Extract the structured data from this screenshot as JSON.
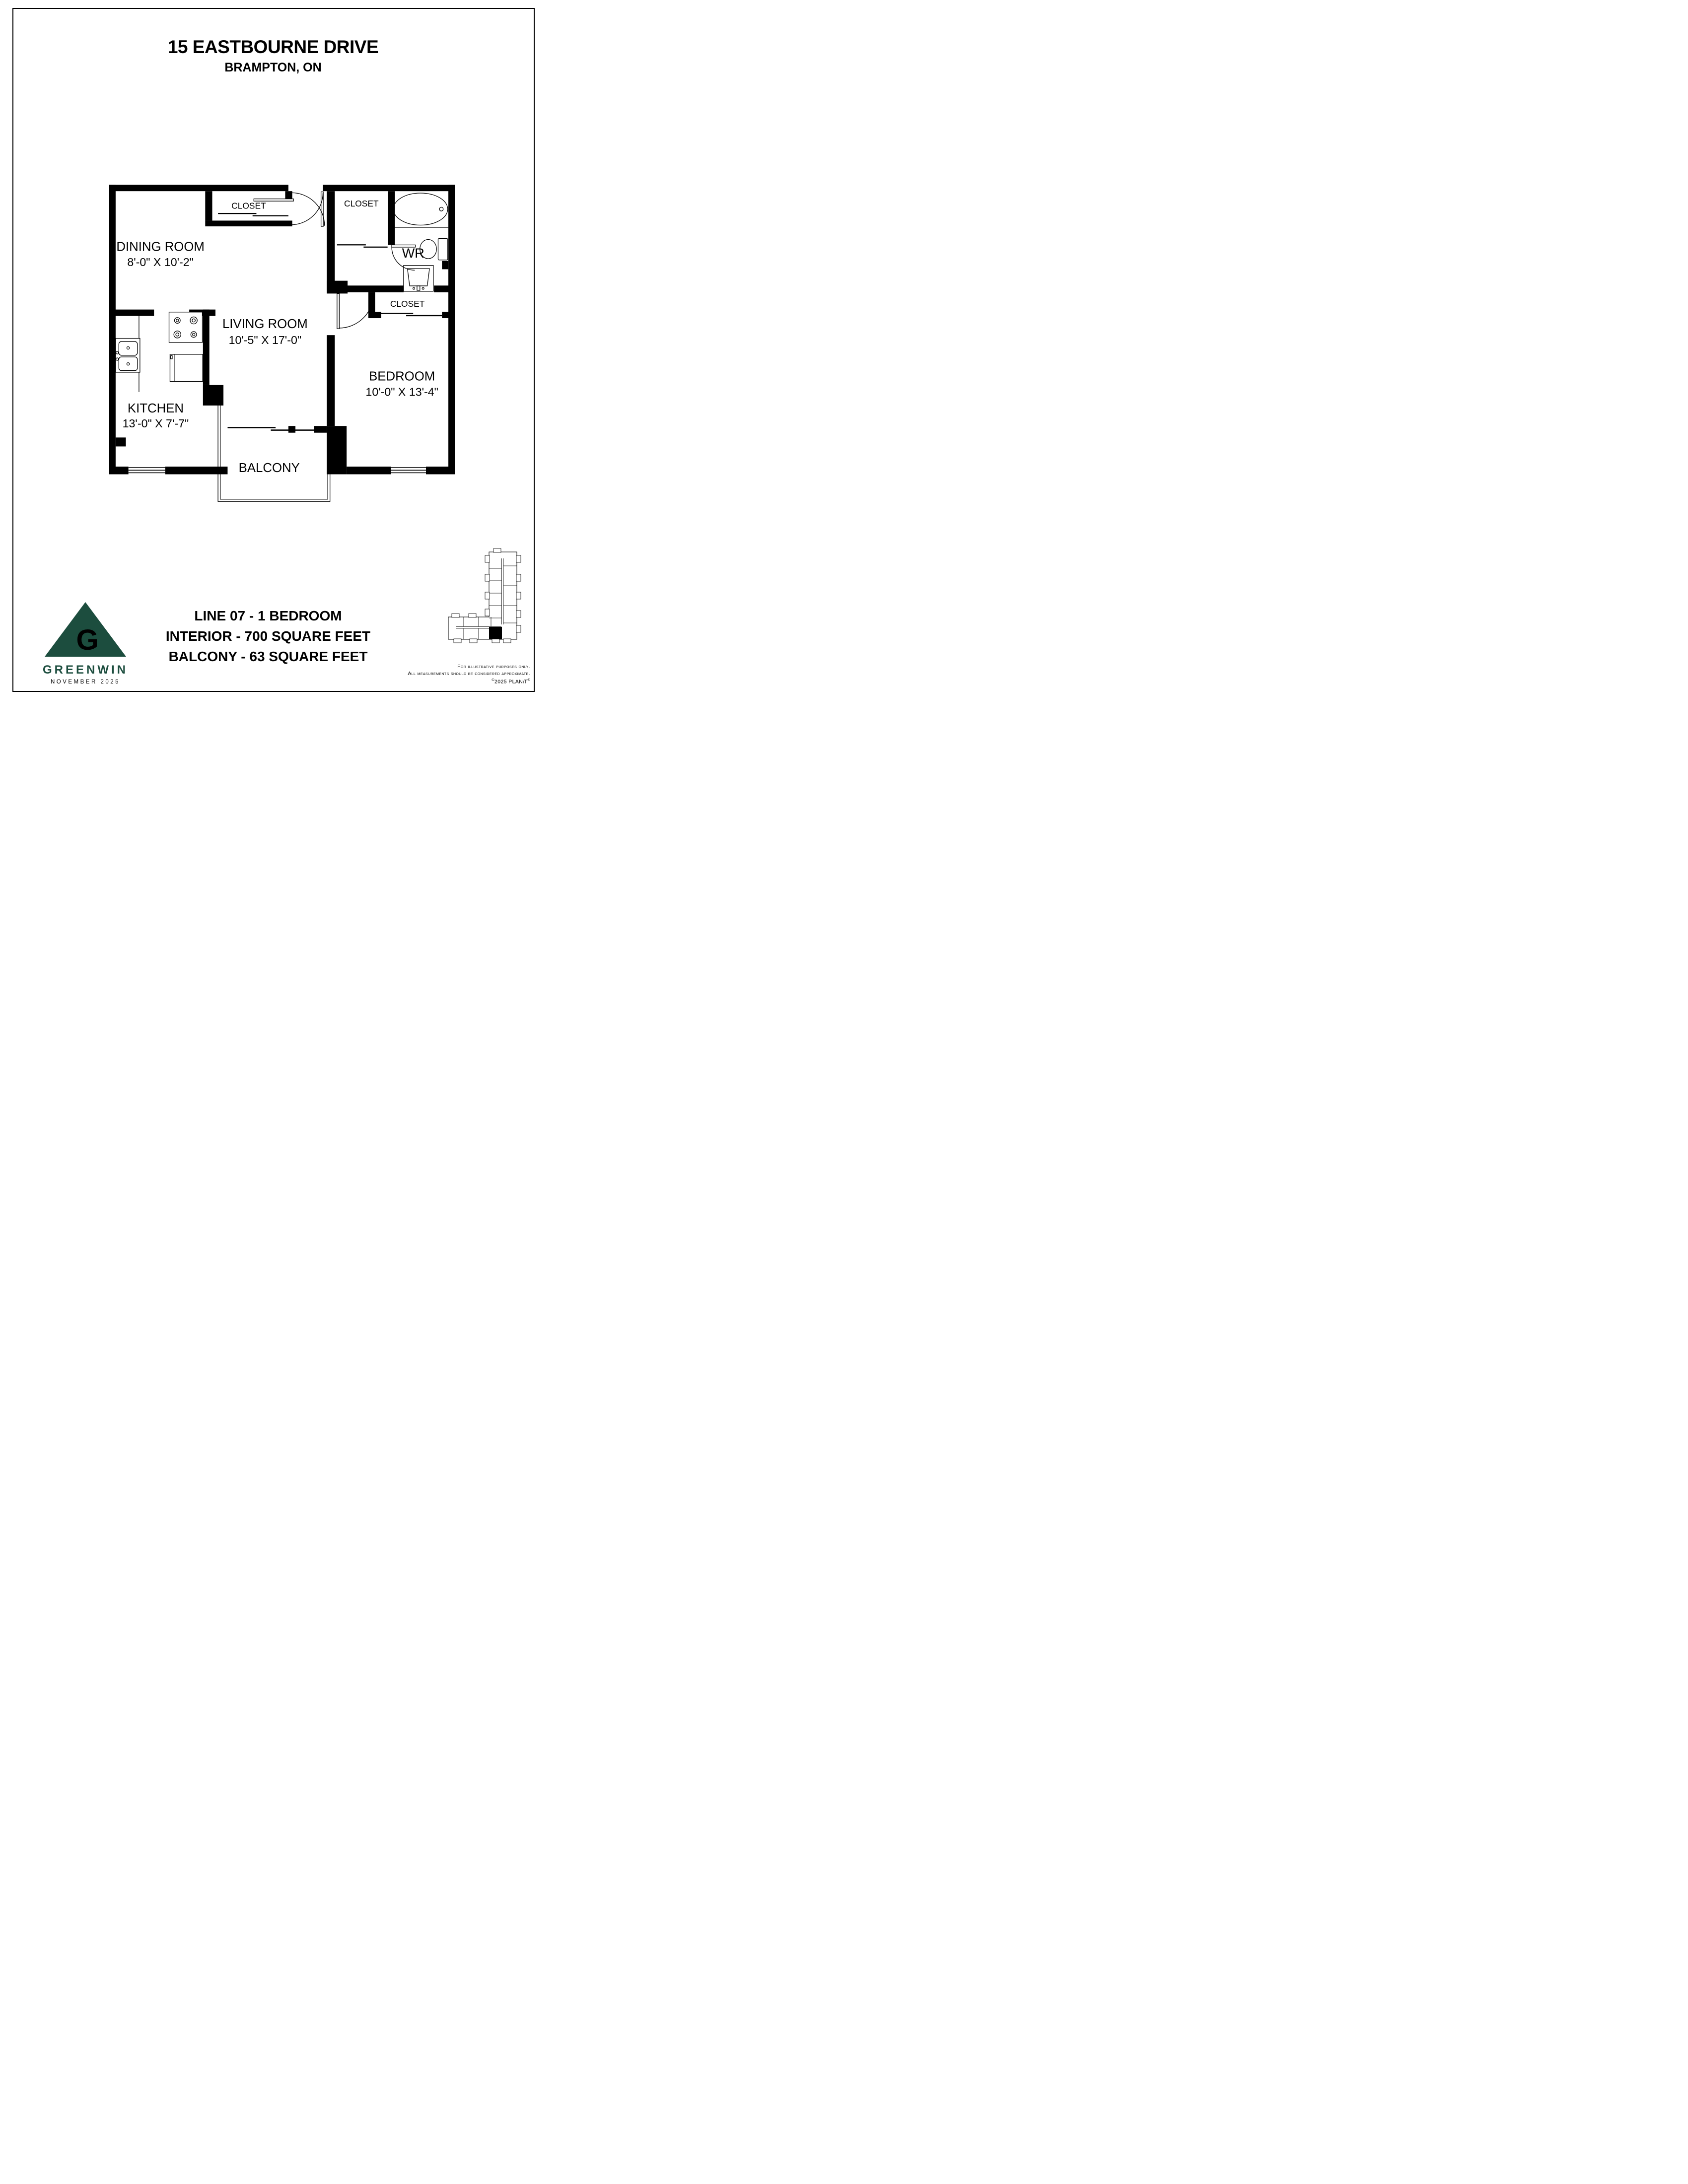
{
  "page": {
    "title": "15 EASTBOURNE DRIVE",
    "subtitle": "BRAMPTON, ON"
  },
  "plan": {
    "rooms": {
      "dining_room": {
        "label": "DINING ROOM",
        "dims": "8'-0\" X 10'-2\""
      },
      "living_room": {
        "label": "LIVING ROOM",
        "dims": "10'-5\" X 17'-0\""
      },
      "kitchen": {
        "label": "KITCHEN",
        "dims": "13'-0\" X 7'-7\""
      },
      "bedroom": {
        "label": "BEDROOM",
        "dims": "10'-0\" X 13'-4\""
      },
      "washroom": {
        "label": "WR"
      },
      "balcony": {
        "label": "BALCONY"
      },
      "closet_entry": {
        "label": "CLOSET"
      },
      "closet_hall": {
        "label": "CLOSET"
      },
      "closet_bedroom": {
        "label": "CLOSET"
      }
    },
    "fixtures": [
      "bathtub-icon",
      "toilet-icon",
      "bathroom-sink-icon",
      "kitchen-sink-icon",
      "stove-icon",
      "fridge-icon"
    ]
  },
  "summary": {
    "line1": "LINE 07 - 1 BEDROOM",
    "line2": "INTERIOR - 700 SQUARE FEET",
    "line3": "BALCONY - 63 SQUARE FEET"
  },
  "branding": {
    "name": "GREENWIN",
    "date": "NOVEMBER 2025",
    "logo_letter": "G",
    "brand_color": "#1C4D3E"
  },
  "disclaimer": {
    "line1": "For illustrative purposes only.",
    "line2": "All measurements should be considered approximate.",
    "line3_copyright": "©",
    "line3_text": "2025 PLANiT",
    "line3_reg": "®"
  }
}
